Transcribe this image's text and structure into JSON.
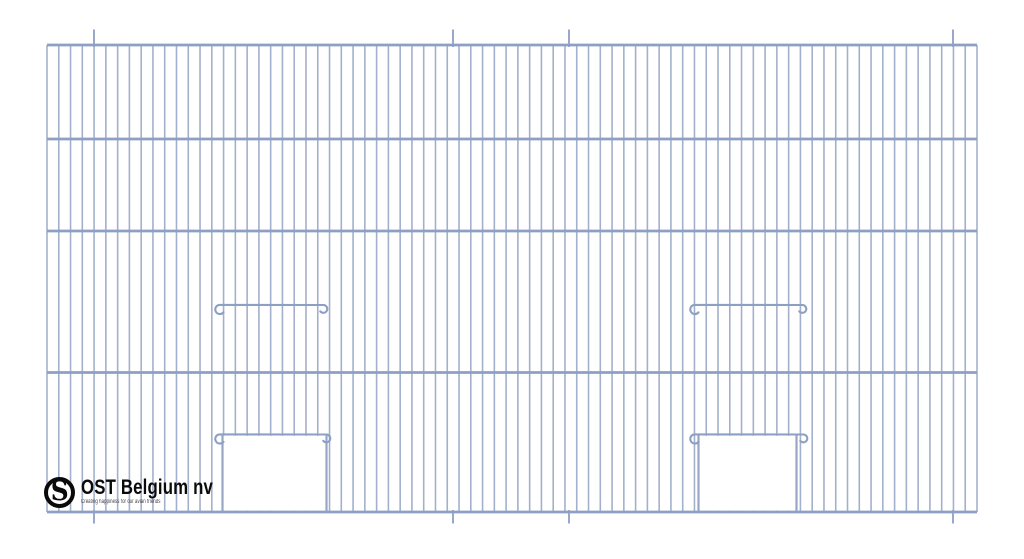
{
  "logo": {
    "name": "OST Belgium nv",
    "tagline": "Creating happiness for our avian friends",
    "monogram": "S"
  },
  "diagram": {
    "description": "Technical drawing of a wire-mesh bird cage front panel with two sliding-door bars and two door openings",
    "canvas": {
      "width": 1024,
      "height": 559,
      "background": "#ffffff"
    },
    "colors": {
      "wire": "#a3b0cc",
      "frame": "#8da0c4",
      "bar": "#8da0c4",
      "edge": "#97a6c6",
      "hanger": "#9aa9c9",
      "opening_fill": "#ffffff"
    },
    "widths": {
      "wire": 1.6,
      "frame": 2.7,
      "bar": 2.1,
      "edge": 2.2,
      "hanger": 2
    },
    "frame": {
      "left": 47,
      "right": 977,
      "top": 45,
      "bottom": 512
    },
    "vertical_wire_count": 80,
    "horizontal_lines_y": [
      45,
      139,
      231,
      372.5,
      512
    ],
    "hangers": {
      "x": [
        94,
        453,
        569,
        953
      ],
      "top_y": 29.5,
      "bottom_y": 523.5
    },
    "doors": [
      {
        "type": "slide-bar",
        "bar": {
          "x1": 212,
          "x2": 328,
          "y": 305
        }
      },
      {
        "type": "slide-bar",
        "bar": {
          "x1": 687,
          "x2": 807,
          "y": 305
        }
      },
      {
        "type": "door-opening",
        "bar": {
          "x1": 212,
          "x2": 331,
          "y": 434.5
        },
        "opening": {
          "x1": 222.5,
          "x2": 326.5,
          "top": 435.8,
          "bottom": 510.6
        }
      },
      {
        "type": "door-opening",
        "bar": {
          "x1": 687,
          "x2": 808,
          "y": 434.5
        },
        "opening": {
          "x1": 698.5,
          "x2": 796.5,
          "top": 435.8,
          "bottom": 510.6
        }
      }
    ]
  }
}
